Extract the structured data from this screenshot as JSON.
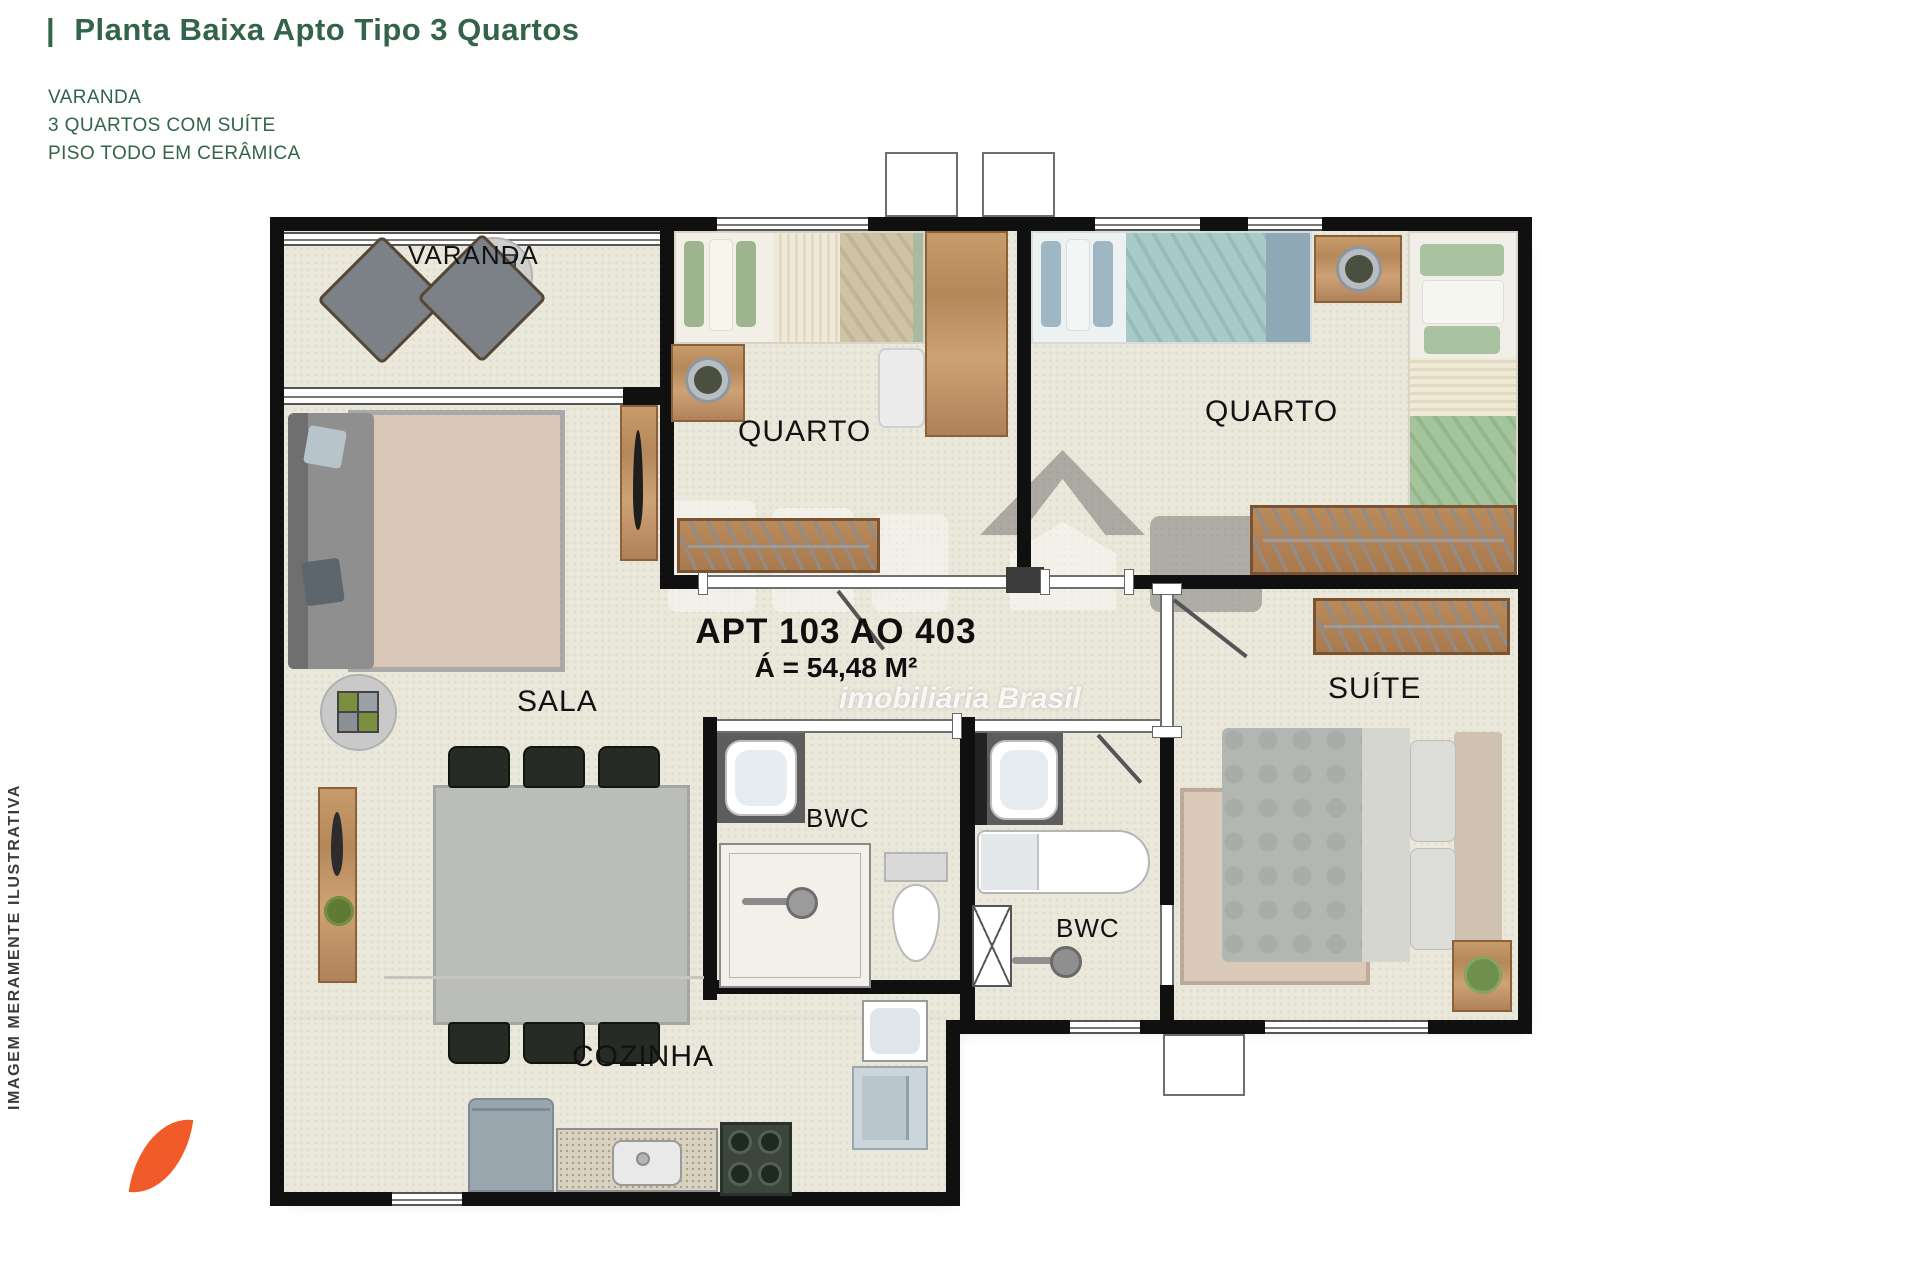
{
  "header": {
    "accent_bar": "|",
    "title": "Planta Baixa Apto Tipo 3 Quartos",
    "features": [
      "VARANDA",
      "3 QUARTOS COM SUÍTE",
      "PISO TODO EM CERÂMICA"
    ]
  },
  "side_note": "IMAGEM MERAMENTE ILUSTRATIVA",
  "apartment": {
    "id_line": "APT 103 AO 403",
    "area_line": "Á = 54,48 M²"
  },
  "rooms": {
    "varanda": "VARANDA",
    "sala": "SALA",
    "quarto_1": "QUARTO",
    "quarto_2": "QUARTO",
    "suite": "SUÍTE",
    "bwc_1": "BWC",
    "bwc_2": "BWC",
    "cozinha": "COZINHA"
  },
  "watermark": {
    "tagline": "imobiliária Brasil"
  },
  "colors": {
    "title_green": "#33634a",
    "leaf_orange": "#f15a29",
    "wall_black": "#101010",
    "floor_beige": "#eae7db"
  }
}
